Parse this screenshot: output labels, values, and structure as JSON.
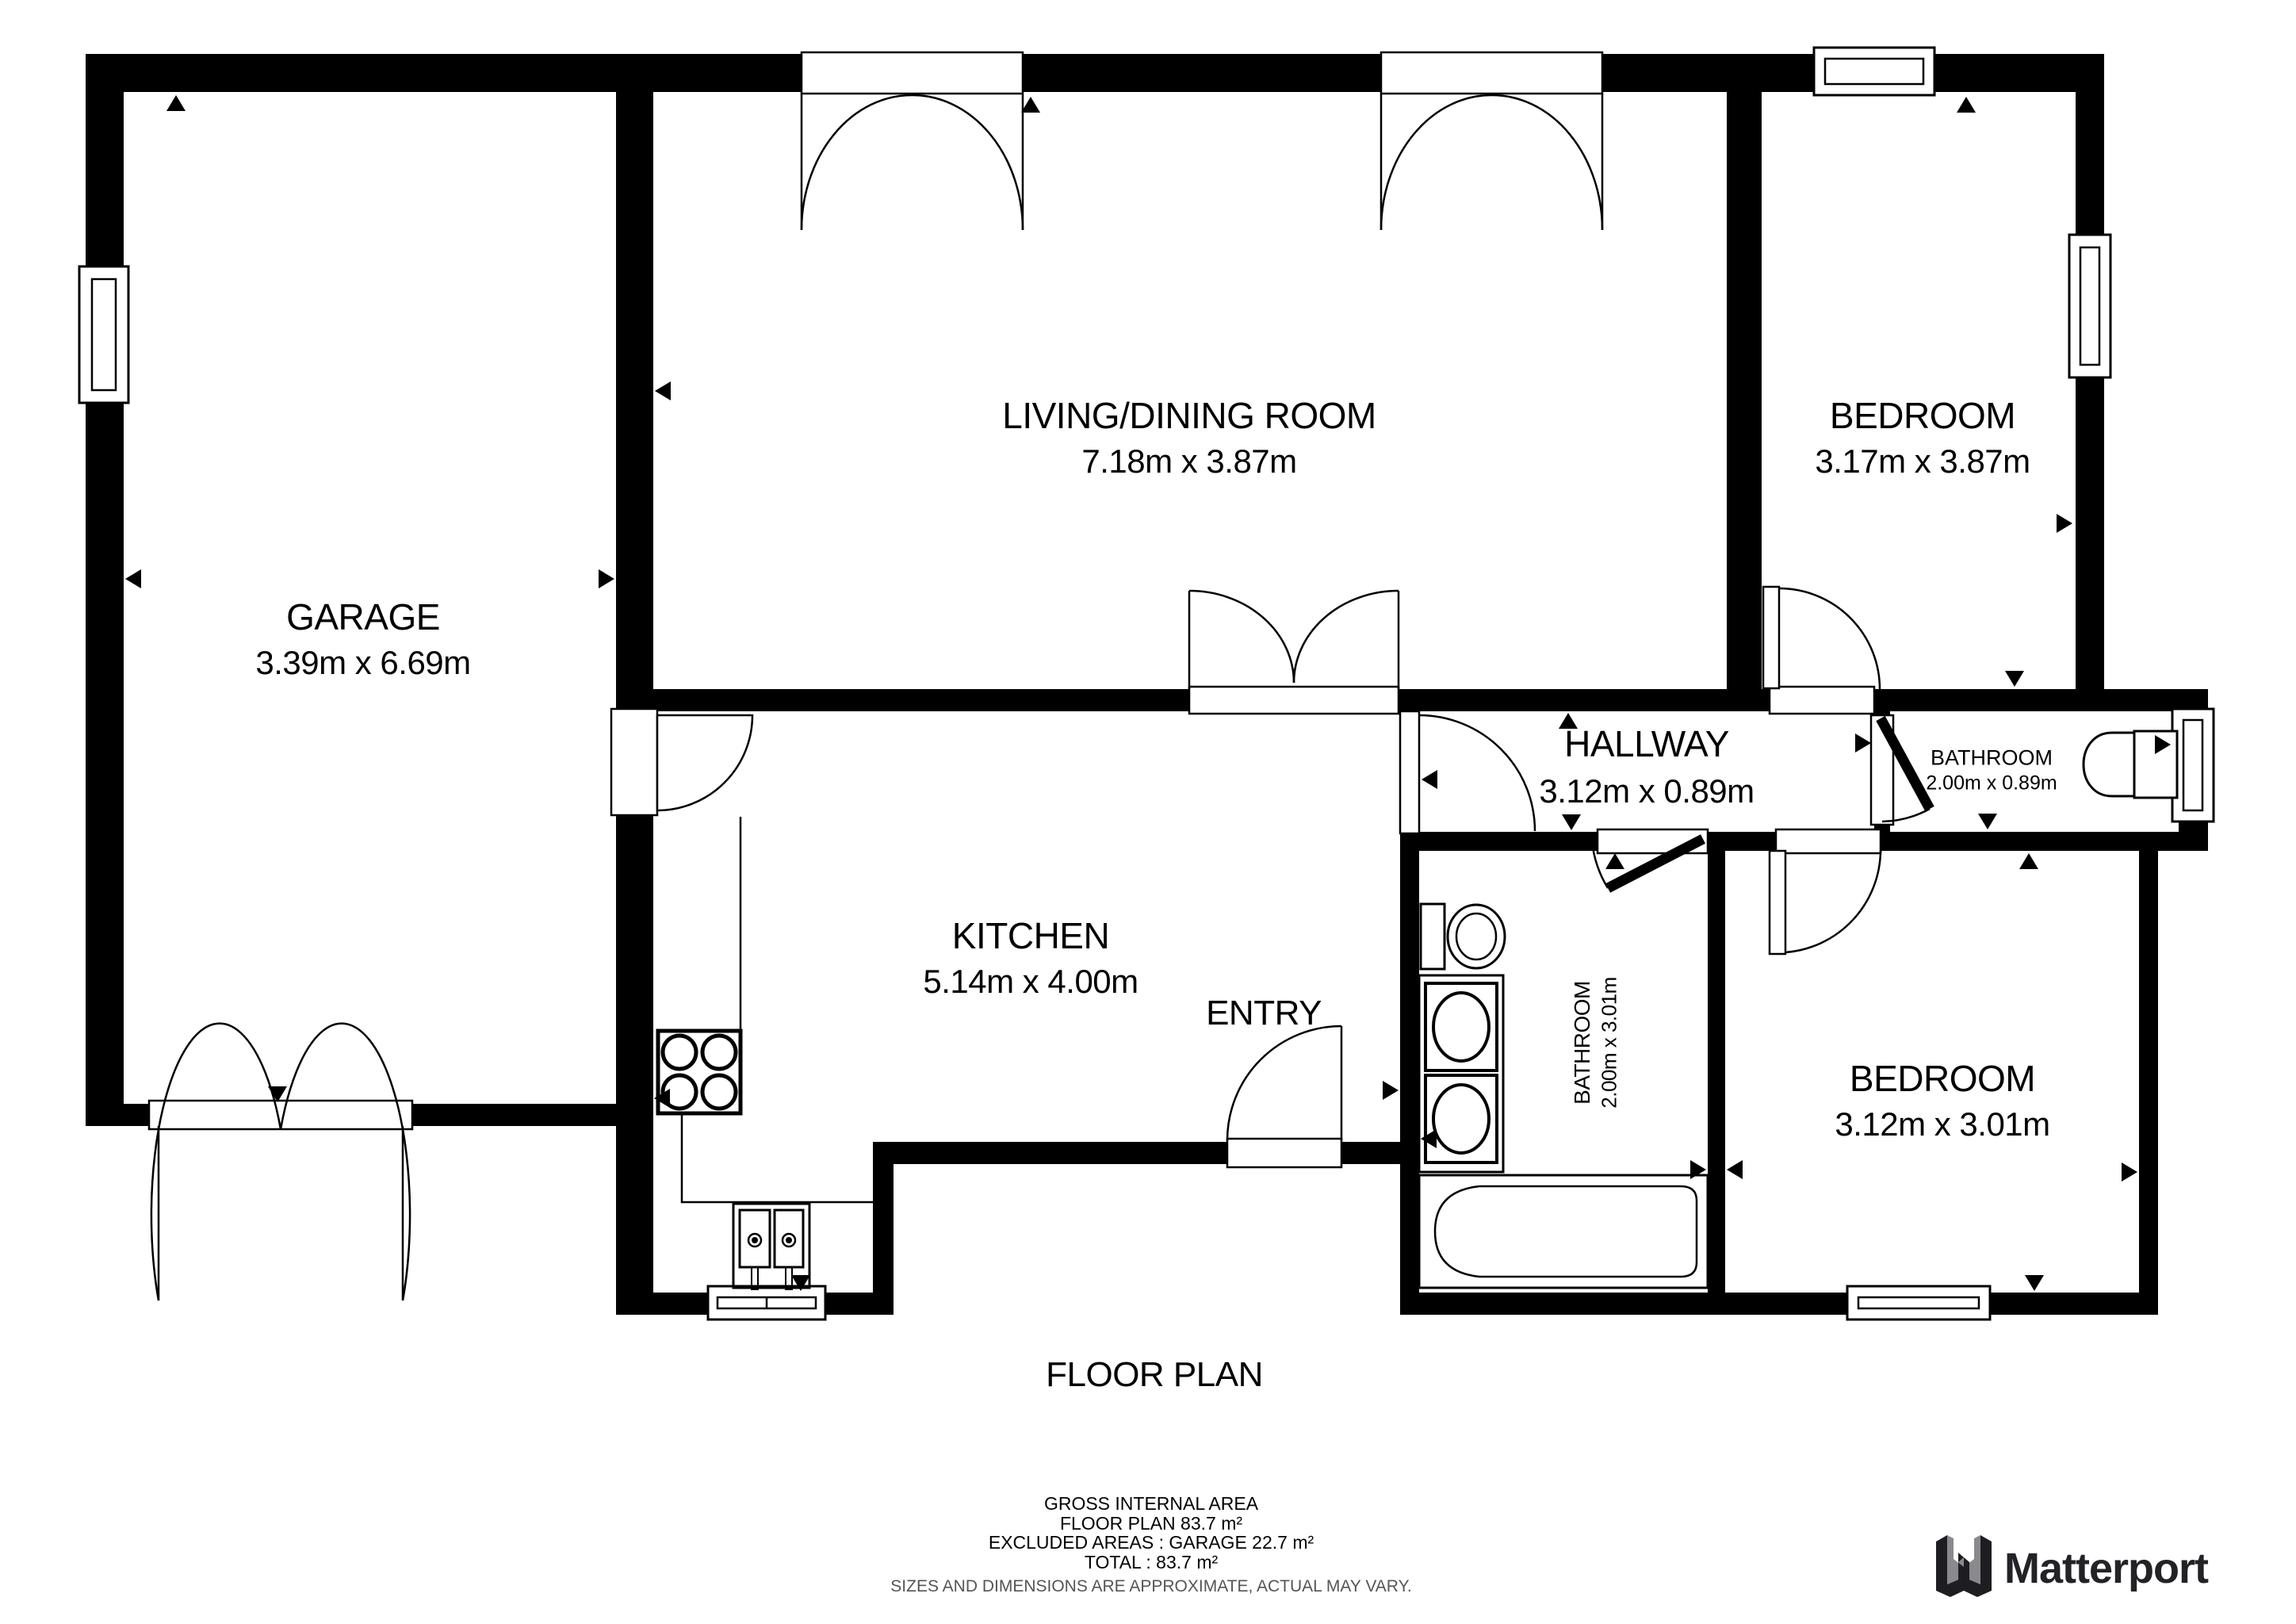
{
  "title": "FLOOR PLAN",
  "rooms": [
    {
      "name": "GARAGE",
      "dims": "3.39m x 6.69m"
    },
    {
      "name": "LIVING/DINING ROOM",
      "dims": "7.18m x 3.87m"
    },
    {
      "name": "BEDROOM",
      "dims": "3.17m x 3.87m"
    },
    {
      "name": "KITCHEN",
      "dims": "5.14m x 4.00m"
    },
    {
      "name": "ENTRY",
      "dims": ""
    },
    {
      "name": "HALLWAY",
      "dims": "3.12m x 0.89m"
    },
    {
      "name": "BATHROOM",
      "dims": "2.00m x 0.89m"
    },
    {
      "name": "BATHROOM",
      "dims": "2.00m x 3.01m"
    },
    {
      "name": "BEDROOM",
      "dims": "3.12m x 3.01m"
    }
  ],
  "footer": {
    "line1": "GROSS INTERNAL AREA",
    "line2": "FLOOR PLAN 83.7 m²",
    "line3": "EXCLUDED AREAS :  GARAGE 22.7 m²",
    "line4": "TOTAL :  83.7 m²",
    "disclaimer": "SIZES AND DIMENSIONS ARE APPROXIMATE, ACTUAL MAY VARY."
  },
  "branding": {
    "logo_text": "Matterport"
  },
  "icons": {
    "logo_mark": "matterport-m-mark",
    "fixtures": [
      "stove-icon",
      "kitchen-sink-icon",
      "toilet-icon",
      "toilet-icon",
      "vanity-sinks-icon",
      "bathtub-icon"
    ]
  },
  "colors": {
    "wall": "#000000",
    "background": "#ffffff",
    "disclaimer_text": "#555555",
    "logo_dark": "#1d1d22",
    "logo_gray": "#8a8a8e"
  }
}
